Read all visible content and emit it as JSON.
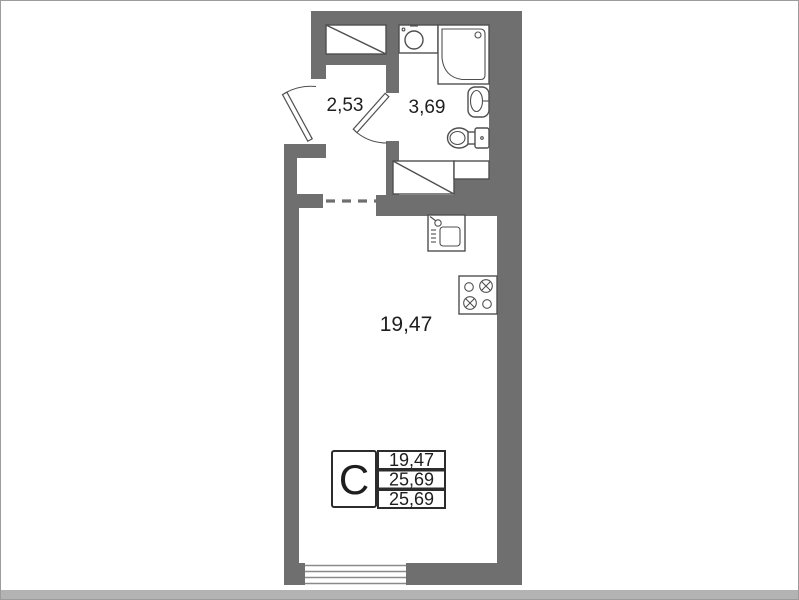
{
  "colors": {
    "wall": "#6f6f6f",
    "fixture_line": "#4f4f4f",
    "text": "#1e1e1e",
    "window_line": "#8a8a8a",
    "frame": "#9c9c9c",
    "bottom_strip": "#b3b3b3"
  },
  "floor_plan": {
    "rooms": [
      {
        "name": "hallway",
        "area": "2,53"
      },
      {
        "name": "bathroom",
        "area": "3,69"
      },
      {
        "name": "living-room",
        "area": "19,47"
      }
    ],
    "legend": {
      "type": "C",
      "values": [
        "19,47",
        "25,69",
        "25,69"
      ]
    },
    "icons": {
      "wardrobe": "rectangle with diagonal",
      "shower": "corner shower cabin",
      "washbasin": "round basin unit",
      "wall_sink": "oval sink on wall",
      "toilet": "toilet with tank",
      "bath_cabinet": "cabinet with diagonal",
      "kitchen_sink": "sink with faucet",
      "stove": "4-burner cooktop",
      "window": "triple-line window",
      "doors": "two swing doors",
      "opening": "dashed opening"
    }
  }
}
